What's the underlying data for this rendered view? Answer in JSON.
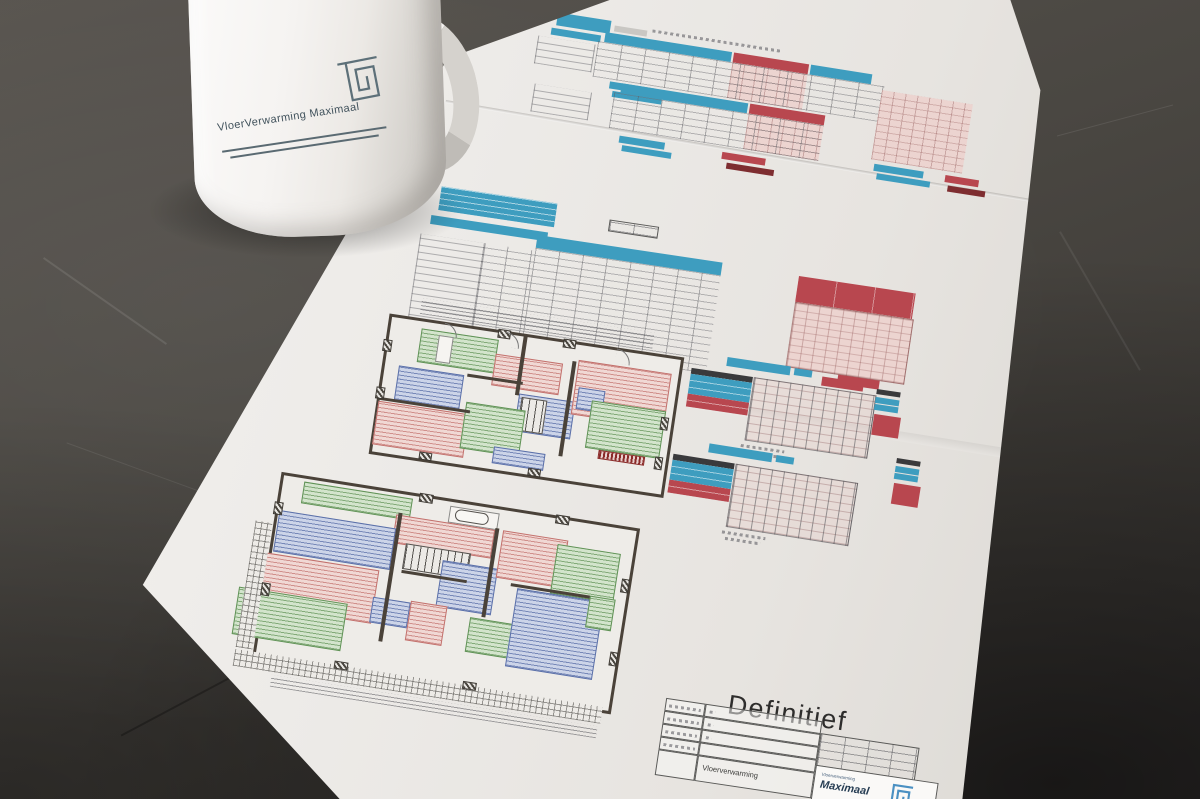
{
  "scene": {
    "surface_color": "#4a4742",
    "shadow_color": "#2e2b28"
  },
  "mug": {
    "brand_text": "VloerVerwarming Maximaal",
    "logo": "square-spiral-icon",
    "body_color": "#f1efec",
    "print_color": "#41525c"
  },
  "titleblock": {
    "status": "Definitief",
    "system_row_value": "Vloerverwarming",
    "logo_small": "Vloerverwarming",
    "logo_main": "Maximaal"
  },
  "palette": {
    "header_blue": "#3e9dbf",
    "header_red": "#b8474f",
    "pink": "#ecd4d0",
    "zone_green": "#5f9155",
    "zone_red": "#c2706c",
    "zone_blue": "#5a6fa8",
    "wall": "#4a4239"
  },
  "legend": {
    "swatches": [
      {
        "color": "#3a3a3c",
        "x": 0,
        "y": 0,
        "w": 24,
        "h": 5
      },
      {
        "color": "#3e9dbf",
        "x": 0,
        "y": 8,
        "w": 24,
        "h": 6
      },
      {
        "color": "#3e9dbf",
        "x": 0,
        "y": 15,
        "w": 24,
        "h": 6
      },
      {
        "color": "#b8474f",
        "x": 1,
        "y": 25,
        "w": 27,
        "h": 21
      }
    ]
  },
  "plans": {
    "floor1": {
      "rooms": [
        [
          44,
          12,
          78,
          34,
          "zg"
        ],
        [
          62,
          16,
          15,
          27,
          "zw"
        ],
        [
          121,
          26,
          68,
          32,
          "zr"
        ],
        [
          27,
          52,
          66,
          35,
          "zb"
        ],
        [
          150,
          62,
          57,
          38,
          "zb"
        ],
        [
          153,
          65,
          26,
          34,
          "zs"
        ],
        [
          12,
          90,
          92,
          44,
          "zr"
        ],
        [
          99,
          78,
          60,
          47,
          "zg"
        ],
        [
          133,
          118,
          52,
          17,
          "zb"
        ],
        [
          204,
          20,
          94,
          55,
          "zr"
        ],
        [
          208,
          47,
          27,
          22,
          "zb"
        ],
        [
          223,
          58,
          75,
          48,
          "zg"
        ],
        [
          237,
          106,
          47,
          9,
          "zm"
        ],
        [
          146,
          4,
          4,
          60,
          "zwall"
        ],
        [
          198,
          22,
          4,
          96,
          "zwall"
        ],
        [
          96,
          50,
          56,
          3,
          "zwall"
        ],
        [
          12,
          86,
          92,
          3,
          "zwall"
        ],
        [
          8,
          28,
          9,
          12,
          "zx"
        ],
        [
          8,
          76,
          9,
          12,
          "zx"
        ],
        [
          120,
          1,
          13,
          9,
          "zx"
        ],
        [
          186,
          1,
          13,
          9,
          "zx"
        ],
        [
          294,
          64,
          8,
          13,
          "zx"
        ],
        [
          294,
          104,
          8,
          13,
          "zx"
        ],
        [
          60,
          134,
          13,
          8,
          "zx"
        ],
        [
          170,
          134,
          13,
          8,
          "zx"
        ],
        [
          66,
          3,
          14,
          14,
          "zarc"
        ],
        [
          128,
          3,
          15,
          15,
          "zarc"
        ],
        [
          240,
          3,
          15,
          15,
          "zarc"
        ]
      ]
    },
    "floor0": {
      "rooms": [
        [
          62,
          12,
          110,
          22,
          "zg"
        ],
        [
          210,
          13,
          50,
          17,
          "zw"
        ],
        [
          216,
          15,
          34,
          12,
          "zt"
        ],
        [
          158,
          30,
          100,
          29,
          "zr"
        ],
        [
          172,
          57,
          66,
          26,
          "zs"
        ],
        [
          42,
          44,
          118,
          42,
          "zb"
        ],
        [
          24,
          88,
          126,
          54,
          "zr"
        ],
        [
          14,
          126,
          110,
          48,
          "zg"
        ],
        [
          211,
          68,
          56,
          47,
          "zb"
        ],
        [
          148,
          115,
          38,
          26,
          "zb"
        ],
        [
          186,
          113,
          37,
          40,
          "zr"
        ],
        [
          266,
          29,
          66,
          48,
          "zr"
        ],
        [
          322,
          34,
          64,
          50,
          "zg"
        ],
        [
          247,
          120,
          67,
          35,
          "zg"
        ],
        [
          289,
          84,
          88,
          79,
          "zb"
        ],
        [
          362,
          80,
          26,
          32,
          "zg"
        ],
        [
          20,
          188,
          372,
          17,
          "zh"
        ],
        [
          20,
          58,
          17,
          128,
          "zh"
        ],
        [
          60,
          208,
          330,
          12,
          "zdim"
        ],
        [
          160,
          28,
          4,
          130,
          "zwall"
        ],
        [
          258,
          28,
          4,
          90,
          "zwall"
        ],
        [
          282,
          80,
          80,
          3,
          "zwall"
        ],
        [
          172,
          84,
          66,
          3,
          "zwall"
        ],
        [
          36,
          36,
          9,
          13,
          "zx"
        ],
        [
          36,
          118,
          9,
          13,
          "zx"
        ],
        [
          178,
          5,
          14,
          9,
          "zx"
        ],
        [
          316,
          5,
          14,
          9,
          "zx"
        ],
        [
          391,
          58,
          8,
          14,
          "zx"
        ],
        [
          391,
          132,
          8,
          14,
          "zx"
        ],
        [
          120,
          184,
          14,
          8,
          "zx"
        ],
        [
          250,
          184,
          14,
          8,
          "zx"
        ]
      ]
    }
  }
}
